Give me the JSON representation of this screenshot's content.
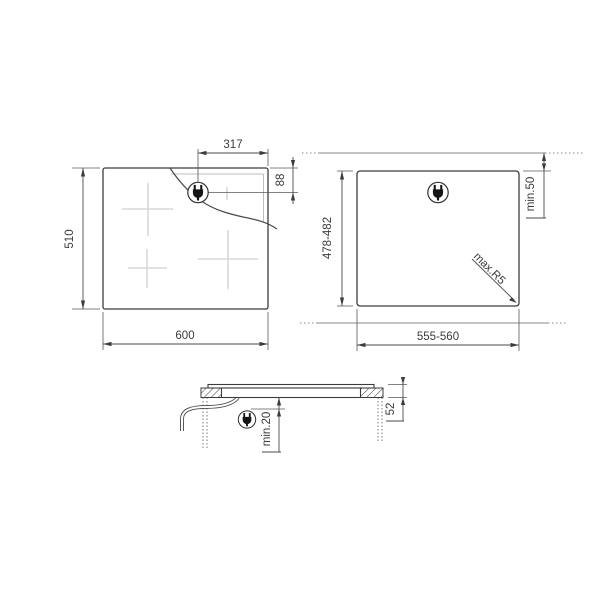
{
  "drawing": {
    "views": {
      "top": {
        "width": "600",
        "depth": "510",
        "plug_from_right": "317",
        "plug_from_top": "88"
      },
      "cutout": {
        "width": "555-560",
        "depth": "478-482",
        "rear_clearance": "min.50",
        "corner_radius": "max.R5"
      },
      "section": {
        "under_clearance": "min.20",
        "build_in_depth": "52"
      }
    },
    "icons": {
      "plug": "power-plug-icon"
    },
    "colors": {
      "line": "#3c3c3c",
      "dimension": "#4a4a4a",
      "light_reference": "#8a8a8a",
      "burner_cross": "#d8d8d8",
      "background": "#ffffff"
    }
  }
}
